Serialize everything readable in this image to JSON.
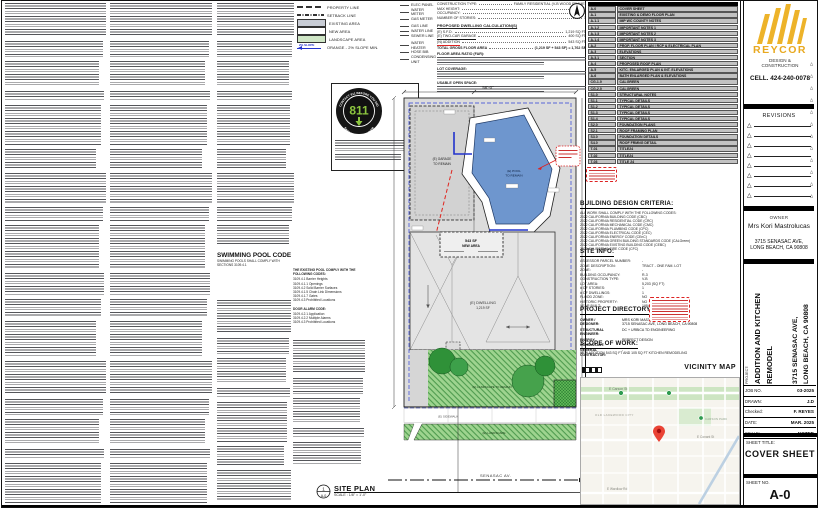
{
  "legend": {
    "rows": [
      {
        "type": "line-dash",
        "label": "PROPERTY LINE"
      },
      {
        "type": "line-dashdot",
        "label": "SETBACK LINE"
      },
      {
        "type": "swatch-existing",
        "label": "EXISTING AREA"
      },
      {
        "type": "swatch-new",
        "label": "NEW AREA"
      },
      {
        "type": "swatch-landscape",
        "label": "LANDSCAPE AREA"
      },
      {
        "type": "slope-arrow",
        "label": "ORANGE - 2% SLOPE MIN.",
        "arrow_text": "2% SLOPE"
      }
    ]
  },
  "utilities": {
    "groups": [
      [
        "ELEC PANEL",
        "WATER METER",
        "GAS METER"
      ],
      [
        "GAS LINE",
        "WATER LINE",
        "SEWER LINE"
      ],
      [
        "WATER HEATER",
        "HOSE BIB",
        "CONDENSING UNIT"
      ]
    ]
  },
  "project_data": {
    "lines": [
      [
        "CONSTRUCTION TYPE:",
        "FAMILY RESIDENTIAL (V-B WOOD FRAME)"
      ],
      [
        "MAX HEIGHT:",
        "16'-2\""
      ],
      [
        "OCCUPANCY:",
        "R-3"
      ],
      [
        "NUMBER OF STORIES:",
        "1"
      ]
    ],
    "calc_heading": "PROPOSED DWELLING CALCULATION(S)",
    "calc_rows": [
      [
        "(E) S.F.D.",
        "1,219 SQ FT"
      ],
      [
        "(E) TWO-CAR GARAGE",
        "400 SQ FT"
      ],
      [
        "(N) ADDITION",
        "543 SQ FT"
      ],
      [
        "TOTAL GROSS FLOOR AREA",
        "(1,219 SF + 543 SF) = 1,762 SF"
      ]
    ],
    "paragraph_leads": [
      "FLOOR AREA RATIO (FAR):",
      "LOT COVERAGE:",
      "USABLE OPEN SPACE:"
    ]
  },
  "badge_811": {
    "number": "811",
    "arc_top": "CONTACT 811 BEFORE YOU DIG",
    "arc_bottom": "SAFE DIGGING PARTNER"
  },
  "pool_code": {
    "title": "SWIMMING POOL CODE",
    "subtitle": "SWIMMING POOLS SHALL COMPLY WITH SECTIONS 3109.4.1",
    "right_heading": "THE EXISTING POOL COMPLY WITH THE FOLLOWING CODES:",
    "codes": [
      "3109.4.1 Barrier Heights",
      "3109.4.1.1 Openings",
      "3109.4.2 Solid Barrier Surfaces",
      "3109.4.1.5 Chain Link Dimensions",
      "3109.4.1.7 Gates",
      "3109.4.3 Prohibited Locations"
    ],
    "alarm_heading": "DOOR ALARM CODE:",
    "alarm_codes": [
      "3109.4.2.1 Application",
      "3109.4.2.2 Multiple Alarms",
      "3109.4.3 Prohibited Locations"
    ]
  },
  "sheet_index": {
    "rows": [
      [
        "A-0",
        "COVER SHEET"
      ],
      [
        "A-1",
        "EXISTING & DEMO FLOOR PLAN"
      ],
      [
        "A-1.1",
        "IMP WC COUNTY NOTES"
      ],
      [
        "A-1.2",
        "IMPORTANT NOTES 1"
      ],
      [
        "A-1.3",
        "IMPORTANT NOTES 2"
      ],
      [
        "A-1.4",
        "IMPORTANT NOTES 3"
      ],
      [
        "A-2",
        "PROP. FLOOR PLAN | RCP & ELECTRICAL PLAN"
      ],
      [
        "A-3",
        "ELEVATIONS"
      ],
      [
        "A-3.1",
        "SECTION"
      ],
      [
        "A-4",
        "PROPOSED ROOF PLAN"
      ],
      [
        "A-5",
        "KITC. ENLARGED PLAN & INT. ELEVATIONS"
      ],
      [
        "A-6",
        "BATH ENLARGED PLAN & ELEVATIONS"
      ],
      [
        "CG-1.0",
        "CALGREEN"
      ],
      [
        "CG-2.0",
        "CALGREEN"
      ],
      [
        "S1.0",
        "STRUCTURAL NOTES"
      ],
      [
        "S1.1",
        "TYPICAL DETAILS"
      ],
      [
        "S1.2",
        "TYPICAL DETAILS"
      ],
      [
        "S1.3",
        "TYPICAL DETAILS"
      ],
      [
        "S1.4",
        "TYPICAL DETAILS"
      ],
      [
        "S2.0",
        "FOUNDATION PLANS"
      ],
      [
        "S2.1",
        "ROOF FRAMING PLAN"
      ],
      [
        "S3.0",
        "FOUNDATION DETAILS"
      ],
      [
        "S4.0",
        "ROOF FRMNG DETAIL"
      ],
      [
        "T-01",
        "TITLE24"
      ],
      [
        "T-02",
        "TITLE24"
      ],
      [
        "T-03",
        "TITLE 24"
      ]
    ]
  },
  "design_criteria": {
    "title": "BUILDING DESIGN CRITERIA:",
    "intro": "ALL WORK SHALL COMPLY WITH THE FOLLOWING CODES:",
    "codes": [
      "2022 CALIFORNIA BUILDING CODE (CBC)",
      "2022 CALIFORNIA RESIDENTIAL CODE (CRC)",
      "2022 CALIFORNIA MECHANICAL CODE (CMC)",
      "2022 CALIFORNIA PLUMBING CODE (CPC)",
      "2022 CALIFORNIA ELECTRICAL CODE (CEC)",
      "2022 CALIFORNIA ENERGY CODE (CEnC)",
      "2022 CALIFORNIA GREEN BUILDING STANDARDS CODE (CALGreen)",
      "2022 CALIFORNIA EXISTING BUILDING CODE (CEBC)",
      "2022 CALIFORNIA FIRE CODE (CFC)"
    ]
  },
  "site_info": {
    "title": "SITE INFO:",
    "rows": [
      [
        "ASSESSOR PARCEL NUMBER:",
        "-"
      ],
      [
        "ZONE DESCRIPTION:",
        "TRACT - ONE FAM. LOT"
      ],
      [
        "ZONE:",
        "-"
      ],
      [
        "BUILDING OCCUPANCY:",
        "R-3"
      ],
      [
        "CONSTRUCTION TYPE:",
        "V-B"
      ],
      [
        "LOT AREA:",
        "5,203 (SQ FT)"
      ],
      [
        "# OF STORIES:",
        "1"
      ],
      [
        "# OF DWELLINGS:",
        "1"
      ],
      [
        "FLOOD ZONE:",
        "NO"
      ],
      [
        "HISTORIC PROPERTY:",
        "NO"
      ],
      [
        "YEAR BUILT:",
        "1954"
      ]
    ]
  },
  "project_directory": {
    "title": "PROJECT DIRECTORY:",
    "rows": [
      [
        "OWNER /\nDESIGNER:",
        "MRS KORI MASTROLUCAS\n3715 SENASAC AVE, LONG BEACH, CA 90808"
      ],
      [
        "STRUCTURAL\nENGINEER:",
        "DC + URBICA TD ENGINEERING"
      ],
      [
        "ENERGY\nCONSULTANT:",
        "PERFECT DESIGN"
      ],
      [
        "GENERAL\nCONTRACTOR:",
        "-"
      ]
    ]
  },
  "scope_of_work": {
    "title": "SCOPE OF WORK:",
    "text": "NEW ADDITION 543 SQ FT AND 105 SQ FT KITCHEN REMODELING"
  },
  "vicinity": {
    "title": "VICINITY MAP",
    "carson": "E Carson St",
    "old_lakewood": "OLD LAKEWOOD CITY",
    "carson_park": "CARSON PARK",
    "conant": "E Conant St",
    "wardlow": "E Wardlow Rd"
  },
  "site_plan": {
    "dim_top": "56'-0\"",
    "garage_label": "(E) GARAGE",
    "garage_label2": "TO REMAIN",
    "pool_label": "(E) POOL",
    "pool_label2": "TO REMAIN",
    "new_area_sf": "543 SF",
    "new_area_label": "NEW AREA",
    "dwelling_label": "(E) DWELLING",
    "dwelling_sf": "1,219 SF",
    "landscape_label": "(E) LANDSCAPE TO REMAIN",
    "sidewalk_label": "(E) SIDEWALK",
    "parkway_label": "(E) LANDSCAPE",
    "street_label": "SENASAC AV.",
    "title": "SITE PLAN",
    "scale": "SCALE : 1/8\" = 1'-0\"",
    "marker_num": "1",
    "marker_sheet": "A-0"
  },
  "titleblock": {
    "brand": "REYCOR",
    "brand_sub": "DESIGN &\nCONSTRUCTION",
    "cell": "CELL.   424-240-0078",
    "revisions_title": "REVISIONS",
    "owner_title": "OWNER",
    "owner_name": "Mrs Kori Mastrolucas",
    "owner_address": "3715 SENASAC AVE,\nLONG BEACH, CA 90808",
    "project_label": "PROJECT:",
    "project_name_line1": "ADDITION AND KITCHEN",
    "project_name_line2": "REMODEL",
    "project_addr_line1": "3715 SENASAC AVE,",
    "project_addr_line2": "LONG BEACH, CA 90808",
    "fields": [
      [
        "JOB NO.",
        "03-2025"
      ],
      [
        "DRAWN:",
        "J.D"
      ],
      [
        "Checked:",
        "F. REYES"
      ],
      [
        "DATE:",
        "MAR. 2025"
      ],
      [
        "SCALE:",
        "NOTED"
      ]
    ],
    "sheet_title_label": "SHEET TITLE:",
    "sheet_title": "COVER SHEET",
    "sheet_no_label": "SHEET NO.",
    "sheet_no": "A-0"
  }
}
